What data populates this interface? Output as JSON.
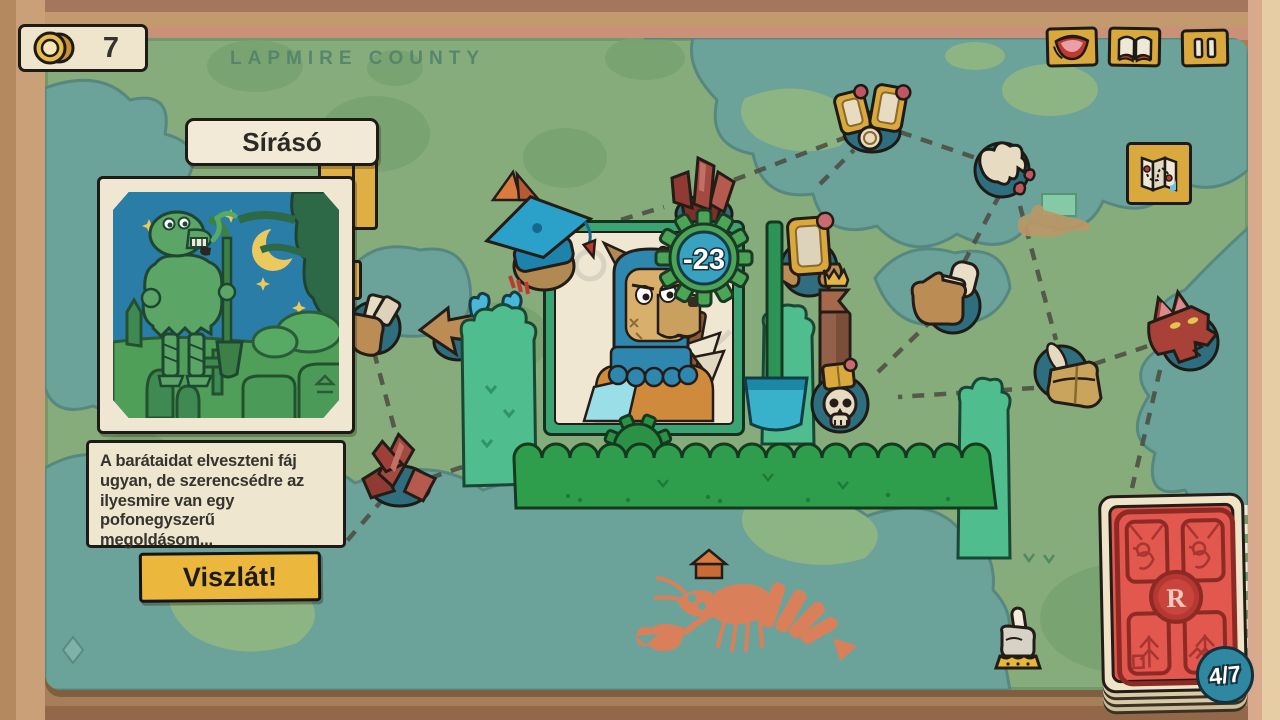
{
  "hud": {
    "coins": "7",
    "coin_icon": "gold-coin",
    "top_buttons": [
      {
        "id": "collection",
        "icon": "mouth-icon"
      },
      {
        "id": "journal",
        "icon": "open-book-icon"
      },
      {
        "id": "pause",
        "icon": "pause-icon"
      }
    ],
    "map_button_icon": "folded-map-icon",
    "deck": {
      "count_label": "4/7",
      "emblem_letter": "R"
    }
  },
  "map": {
    "region_title": "LAPMIRE COUNTY",
    "nodes": [
      {
        "id": "twin-mirrors"
      },
      {
        "id": "ink-spill"
      },
      {
        "id": "reaching-hands"
      },
      {
        "id": "satchel-feather"
      },
      {
        "id": "dragon-head"
      },
      {
        "id": "crystals-north"
      },
      {
        "id": "framed-portrait"
      },
      {
        "id": "crowned-skull"
      },
      {
        "id": "crystals-west"
      },
      {
        "id": "card-hand"
      },
      {
        "id": "pointing-hand"
      }
    ],
    "decorations": [
      "tent",
      "duck-flag",
      "house",
      "crawfish",
      "diamond",
      "banner-flag"
    ]
  },
  "event_panel": {
    "title": "Sírásó",
    "description": "A barátaidat elveszteni fáj ugyan, de szerencsédre az ilyesmire van egy pofonegyszerű megoldásom...",
    "action_label": "Viszlát!"
  },
  "encounter": {
    "modifier": "-23"
  },
  "colors": {
    "rug_green": "#86ac7c",
    "pond_teal": "#6ba39b",
    "gold": "#d9a93e",
    "cream": "#efe5cd",
    "card_red": "#e2574e",
    "badge_teal": "#2f87a0",
    "gear_green": "#4ca456",
    "mint": "#4fbd8d",
    "hedge": "#2f9e4c"
  }
}
